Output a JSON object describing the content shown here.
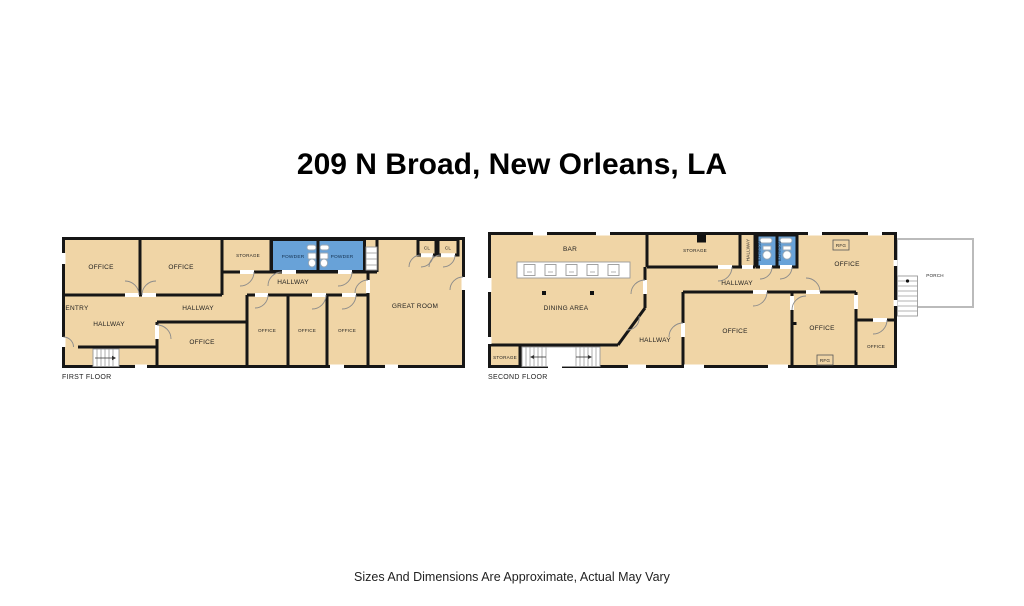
{
  "title": "209 N Broad, New Orleans, LA",
  "footer": "Sizes And Dimensions Are Approximate, Actual May Vary",
  "colors": {
    "room_fill": "#f0d5a6",
    "wet_room_fill": "#68a2d8",
    "wall": "#161616",
    "porch_wall": "#bbbbbb",
    "label": "#1f1f1f"
  },
  "floor1": {
    "label": "FIRST FLOOR",
    "rooms": {
      "office_tl": "OFFICE",
      "office_tm": "OFFICE",
      "storage": "STORAGE",
      "powder_left": "POWDER",
      "powder_right": "POWDER",
      "hallway_top": "HALLWAY",
      "entry": "ENTRY",
      "hallway_left": "HALLWAY",
      "hallway_mid": "HALLWAY",
      "office_center": "OFFICE",
      "office_small_1": "OFFICE",
      "office_small_2": "OFFICE",
      "office_small_3": "OFFICE",
      "great_room": "GREAT ROOM",
      "closet_1": "CL",
      "closet_2": "CL"
    }
  },
  "floor2": {
    "label": "SECOND FLOOR",
    "rooms": {
      "bar": "BAR",
      "dining": "DINING AREA",
      "storage_lower": "STORAGE",
      "storage_upper": "STORAGE",
      "hallway_small": "HALLWAY",
      "bathroom_1": "BATHROOM",
      "bathroom_2": "BATHROOM",
      "hallway_main": "HALLWAY",
      "hallway_diag": "HALLWAY",
      "office_top": "OFFICE",
      "office_mid": "OFFICE",
      "office_right": "OFFICE",
      "office_small": "OFFICE",
      "fridge_top": "RFG",
      "fridge_bottom": "RFG",
      "porch": "PORCH"
    }
  }
}
